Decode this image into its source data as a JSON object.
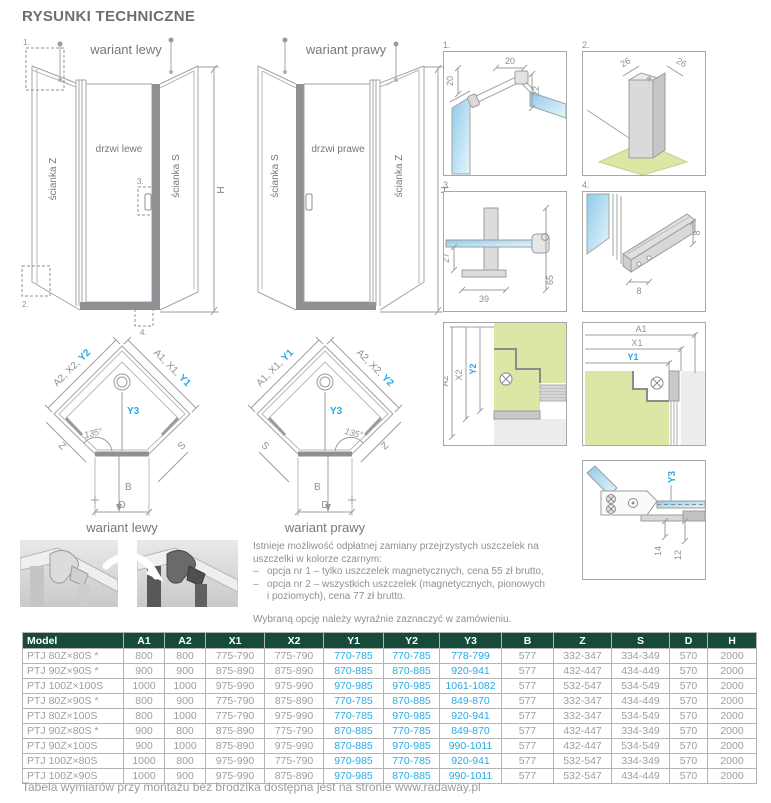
{
  "page": {
    "title": "RYSUNKI TECHNICZNE",
    "footer": "Tabela wymiarów przy montażu bez brodzika dostępna jest na stronie www.radaway.pl"
  },
  "colors": {
    "accent_blue": "#29abe2",
    "header_green": "#174a3a"
  },
  "elevations": {
    "left": {
      "caption": "wariant lewy",
      "wall_left": "ścianka Z",
      "door": "drzwi lewe",
      "wall_right": "ścianka S",
      "h": "H",
      "m1": "1.",
      "m2": "2.",
      "m3": "3.",
      "m4": "4."
    },
    "right": {
      "caption": "wariant prawy",
      "wall_left": "ścianka S",
      "door": "drzwi prawe",
      "wall_right": "ścianka Z",
      "h": "H"
    }
  },
  "plans": {
    "left": {
      "caption": "wariant lewy",
      "edge_left": "A2, X2, ",
      "edge_left_hl": "Y2",
      "edge_right": "A1, X1, ",
      "edge_right_hl": "Y1",
      "y3": "Y3",
      "angle": "135°",
      "side_left": "Z",
      "side_right": "S",
      "b": "B",
      "d": "D"
    },
    "right": {
      "caption": "wariant prawy",
      "edge_left": "A1, X1, ",
      "edge_left_hl": "Y1",
      "edge_right": "A2, X2, ",
      "edge_right_hl": "Y2",
      "y3": "Y3",
      "angle": "135°",
      "side_left": "S",
      "side_right": "Z",
      "b": "B",
      "d": "D"
    }
  },
  "details": {
    "d1": {
      "label": "1.",
      "dim_a": "20",
      "dim_b": "20",
      "dim_c": "22"
    },
    "d2": {
      "label": "2.",
      "dim_a": "26",
      "dim_b": "26"
    },
    "d3": {
      "label": "3.",
      "dim_a": "27",
      "dim_b": "39",
      "dim_c": "65"
    },
    "d4": {
      "label": "4.",
      "dim_a": "8",
      "dim_b": "8"
    },
    "plan_left": {
      "a": "A2",
      "x": "X2",
      "y": "Y2"
    },
    "plan_right": {
      "a": "A1",
      "x": "X1",
      "y": "Y1"
    },
    "hinge": {
      "y": "Y3",
      "dim_a": "14",
      "dim_b": "12"
    }
  },
  "notes": {
    "intro": "Istnieje możliwość odpłatnej zamiany przejrzystych uszczelek na uszczelki w kolorze czarnym:",
    "dash": "–",
    "bullet1": "opcja nr 1 – tylko uszczelek magnetycznych, cena 55 zł brutto,",
    "bullet2": "opcja nr 2 – wszystkich uszczelek (magnetycznych, pionowych i poziomych), cena 77 zł brutto.",
    "outro": "Wybraną opcję należy wyraźnie zaznaczyć w zamówieniu."
  },
  "table": {
    "headers": [
      "Model",
      "A1",
      "A2",
      "X1",
      "X2",
      "Y1",
      "Y2",
      "Y3",
      "B",
      "Z",
      "S",
      "D",
      "H"
    ],
    "blue_columns": [
      5,
      6,
      7
    ],
    "rows": [
      [
        "PTJ 80Z×80S *",
        "800",
        "800",
        "775-790",
        "775-790",
        "770-785",
        "770-785",
        "778-799",
        "577",
        "332-347",
        "334-349",
        "570",
        "2000"
      ],
      [
        "PTJ 90Z×90S *",
        "900",
        "900",
        "875-890",
        "875-890",
        "870-885",
        "870-885",
        "920-941",
        "577",
        "432-447",
        "434-449",
        "570",
        "2000"
      ],
      [
        "PTJ 100Z×100S",
        "1000",
        "1000",
        "975-990",
        "975-990",
        "970-985",
        "970-985",
        "1061-1082",
        "577",
        "532-547",
        "534-549",
        "570",
        "2000"
      ],
      [
        "PTJ 80Z×90S *",
        "800",
        "900",
        "775-790",
        "875-890",
        "770-785",
        "870-885",
        "849-870",
        "577",
        "332-347",
        "434-449",
        "570",
        "2000"
      ],
      [
        "PTJ 80Z×100S",
        "800",
        "1000",
        "775-790",
        "975-990",
        "770-785",
        "970-985",
        "920-941",
        "577",
        "332-347",
        "534-549",
        "570",
        "2000"
      ],
      [
        "PTJ 90Z×80S *",
        "900",
        "800",
        "875-890",
        "775-790",
        "870-885",
        "770-785",
        "849-870",
        "577",
        "432-447",
        "334-349",
        "570",
        "2000"
      ],
      [
        "PTJ 90Z×100S",
        "900",
        "1000",
        "875-890",
        "975-990",
        "870-885",
        "970-985",
        "990-1011",
        "577",
        "432-447",
        "534-549",
        "570",
        "2000"
      ],
      [
        "PTJ 100Z×80S",
        "1000",
        "800",
        "975-990",
        "775-790",
        "970-985",
        "770-785",
        "920-941",
        "577",
        "532-547",
        "334-349",
        "570",
        "2000"
      ],
      [
        "PTJ 100Z×90S",
        "1000",
        "900",
        "975-990",
        "875-890",
        "970-985",
        "870-885",
        "990-1011",
        "577",
        "532-547",
        "434-449",
        "570",
        "2000"
      ]
    ]
  }
}
